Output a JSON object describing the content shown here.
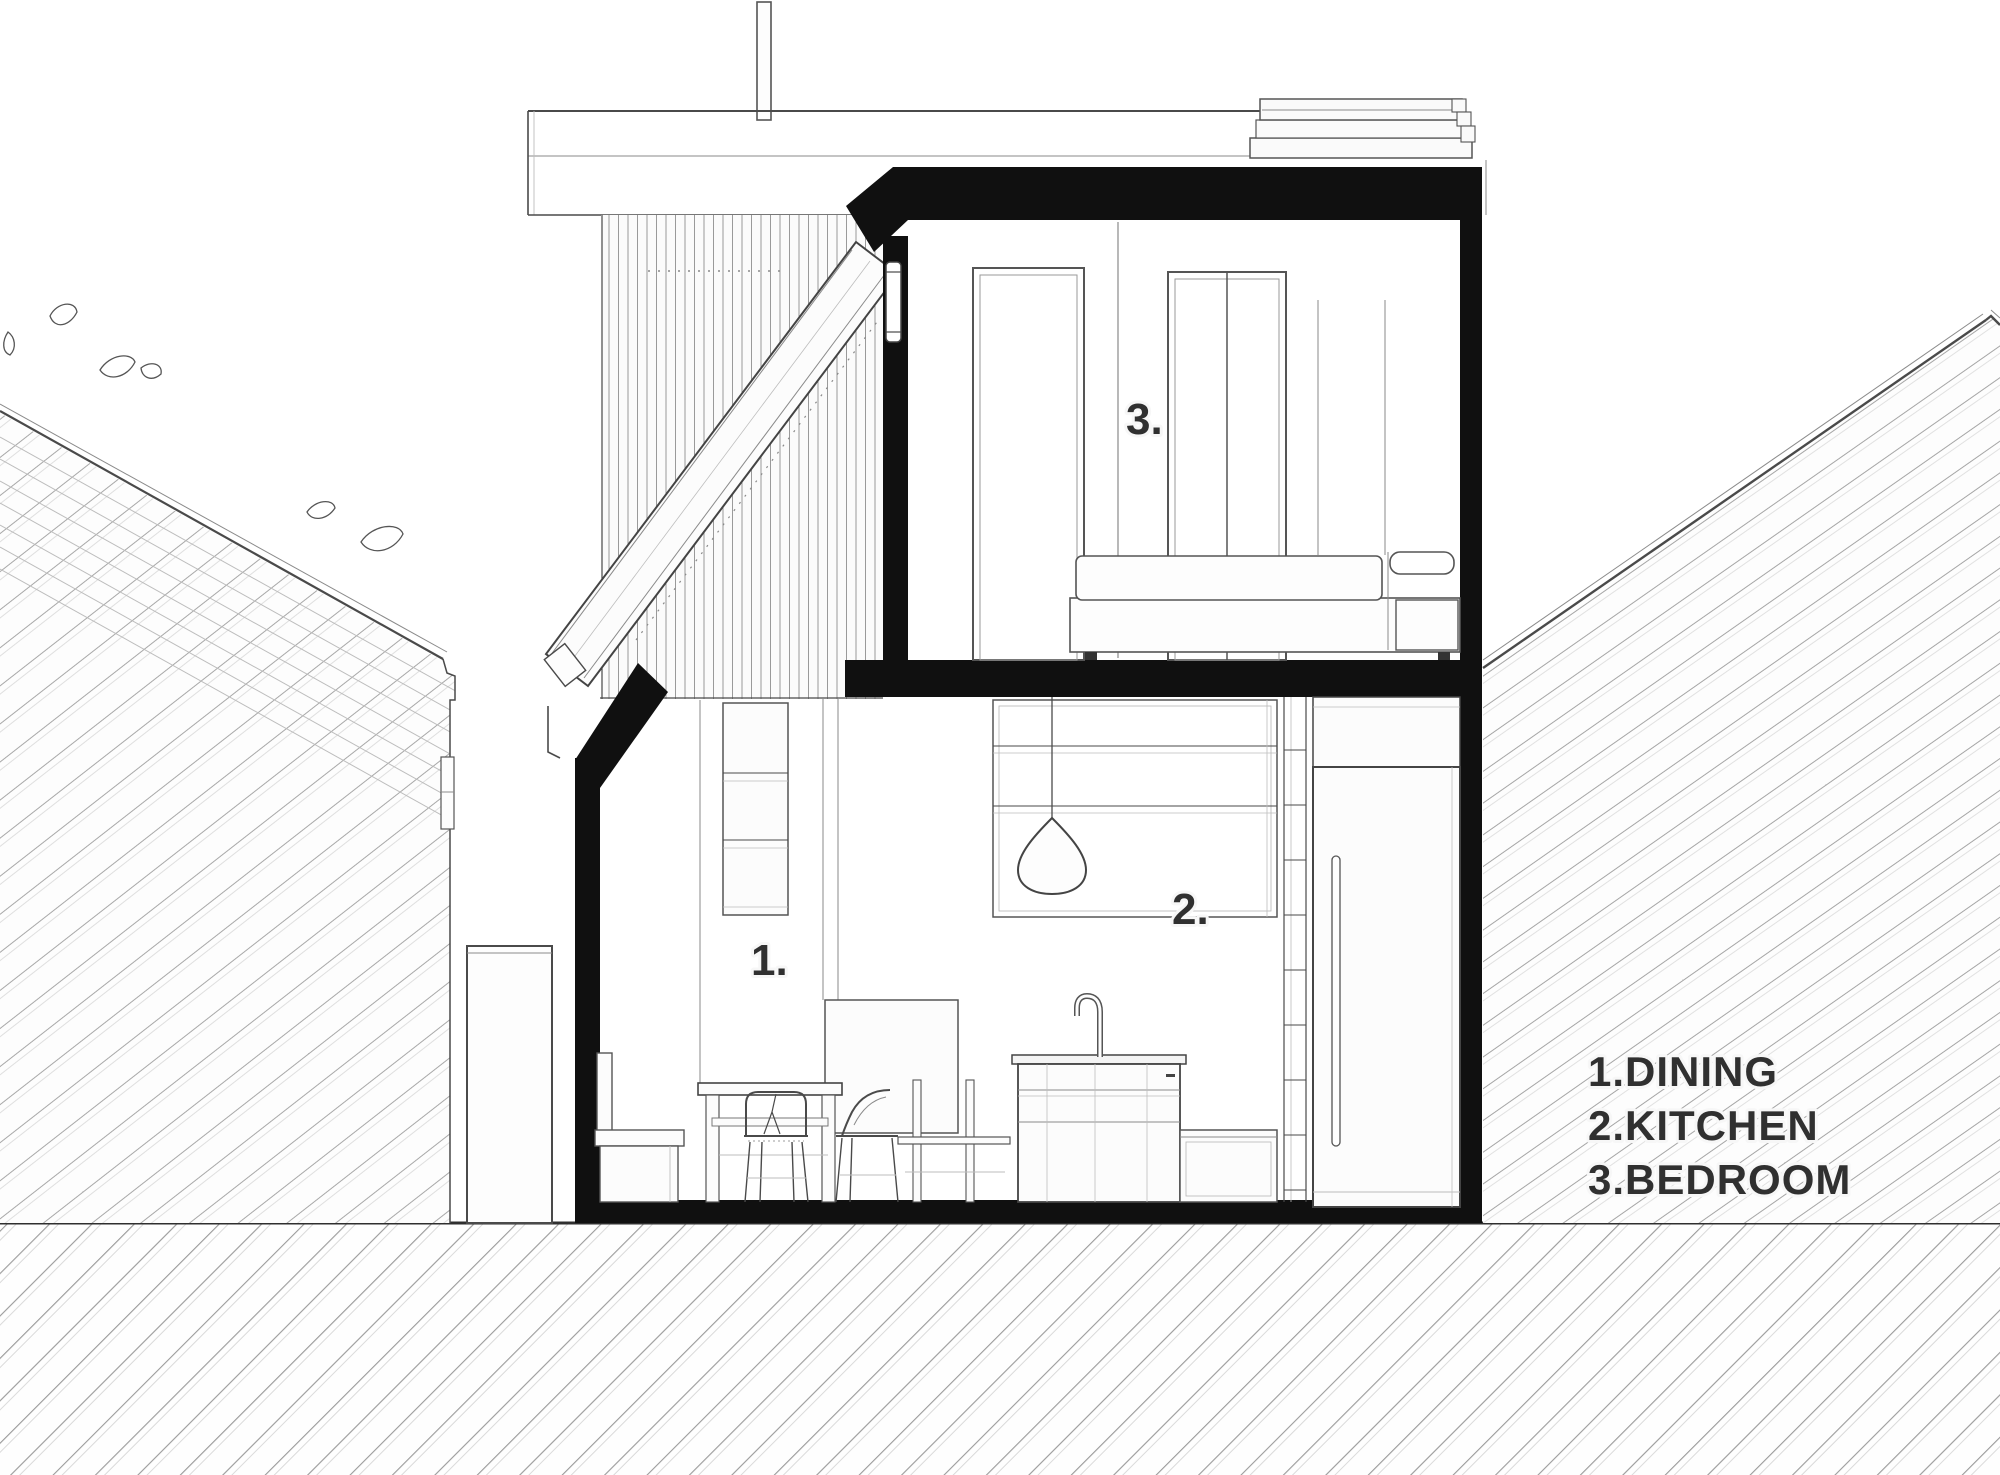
{
  "drawing_type": "architectural cross-section",
  "colors": {
    "background": "#ffffff",
    "poche": "#101010",
    "line_dark": "#4a4a4a",
    "line_light": "#9a9a9a",
    "hatch": "#a8a8a8",
    "ground_line": "#2f2f2f",
    "text": "#303030"
  },
  "room_labels": {
    "dining": "1.",
    "kitchen": "2.",
    "bedroom": "3."
  },
  "legend": {
    "items": [
      {
        "label": "1.DINING"
      },
      {
        "label": "2.KITCHEN"
      },
      {
        "label": "3.BEDROOM"
      }
    ]
  }
}
